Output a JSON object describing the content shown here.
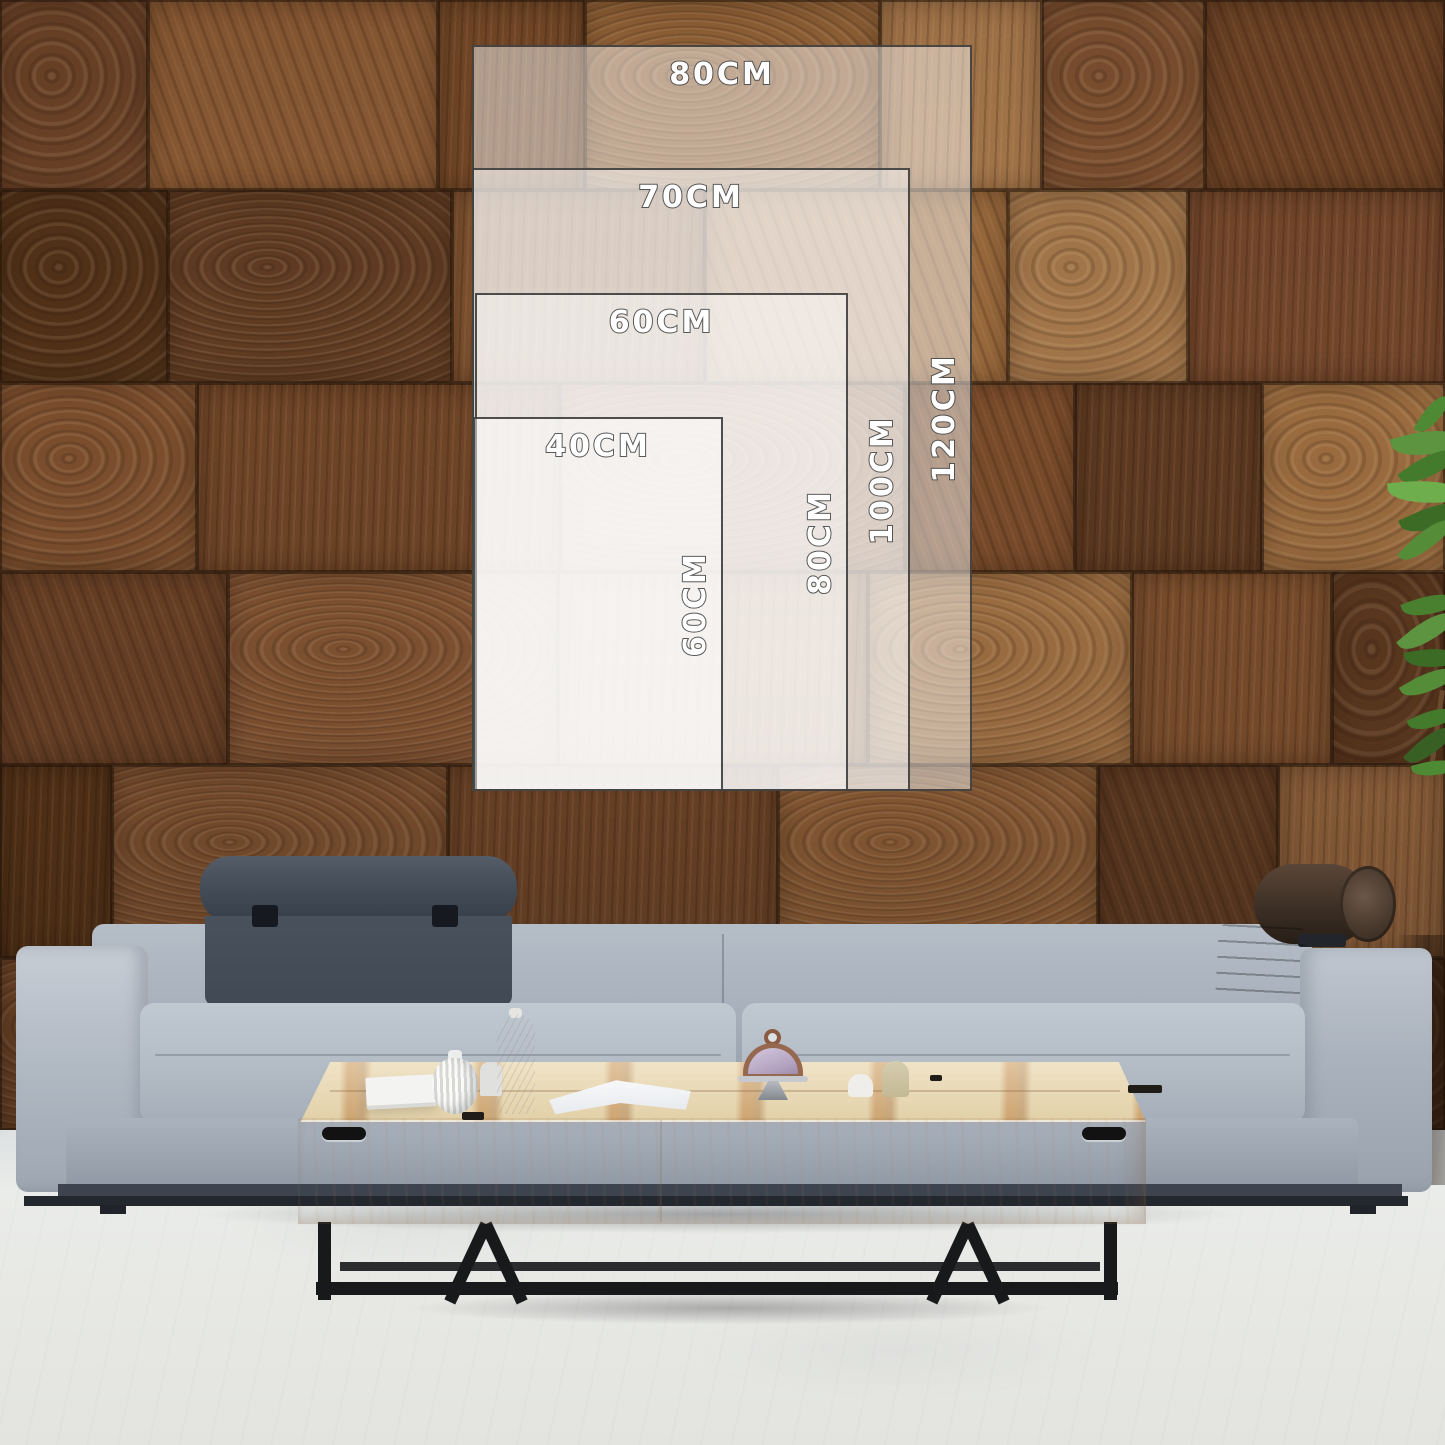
{
  "size_guide": {
    "unit": "CM",
    "options": [
      {
        "width_cm": 80,
        "height_cm": 120,
        "width_label": "80CM",
        "height_label": "120CM"
      },
      {
        "width_cm": 70,
        "height_cm": 100,
        "width_label": "70CM",
        "height_label": "100CM"
      },
      {
        "width_cm": 60,
        "height_cm": 80,
        "width_label": "60CM",
        "height_label": "80CM"
      },
      {
        "width_cm": 40,
        "height_cm": 60,
        "width_label": "40CM",
        "height_label": "60CM"
      }
    ],
    "style": {
      "overlay_tint": "#FFFFFF",
      "overlay_opacity": 0.47,
      "border_color": "#3C3C3C",
      "label_fill": "#FFFFFF",
      "label_outline": "#4A4A4A"
    }
  },
  "scene": {
    "description": "Living room mockup: end-grain wood block wall, gray fabric sofa with quilted headrest and leather bolster, light wood coffee table with black metal legs, plant at right edge",
    "colors": {
      "wood_mid": "#7B4E2D",
      "wood_dark": "#53321B",
      "wood_light": "#A07144",
      "sofa_fabric": "#AEB6C1",
      "headrest_quilt": "#454D59",
      "bolster_leather": "#3B2D23",
      "table_wood_top": "#EAD8B2",
      "table_wood_face": "#F1E8D6",
      "metal_legs": "#1D1F21",
      "floor": "#E8EAEA",
      "plant_green": "#4E8A33"
    }
  }
}
